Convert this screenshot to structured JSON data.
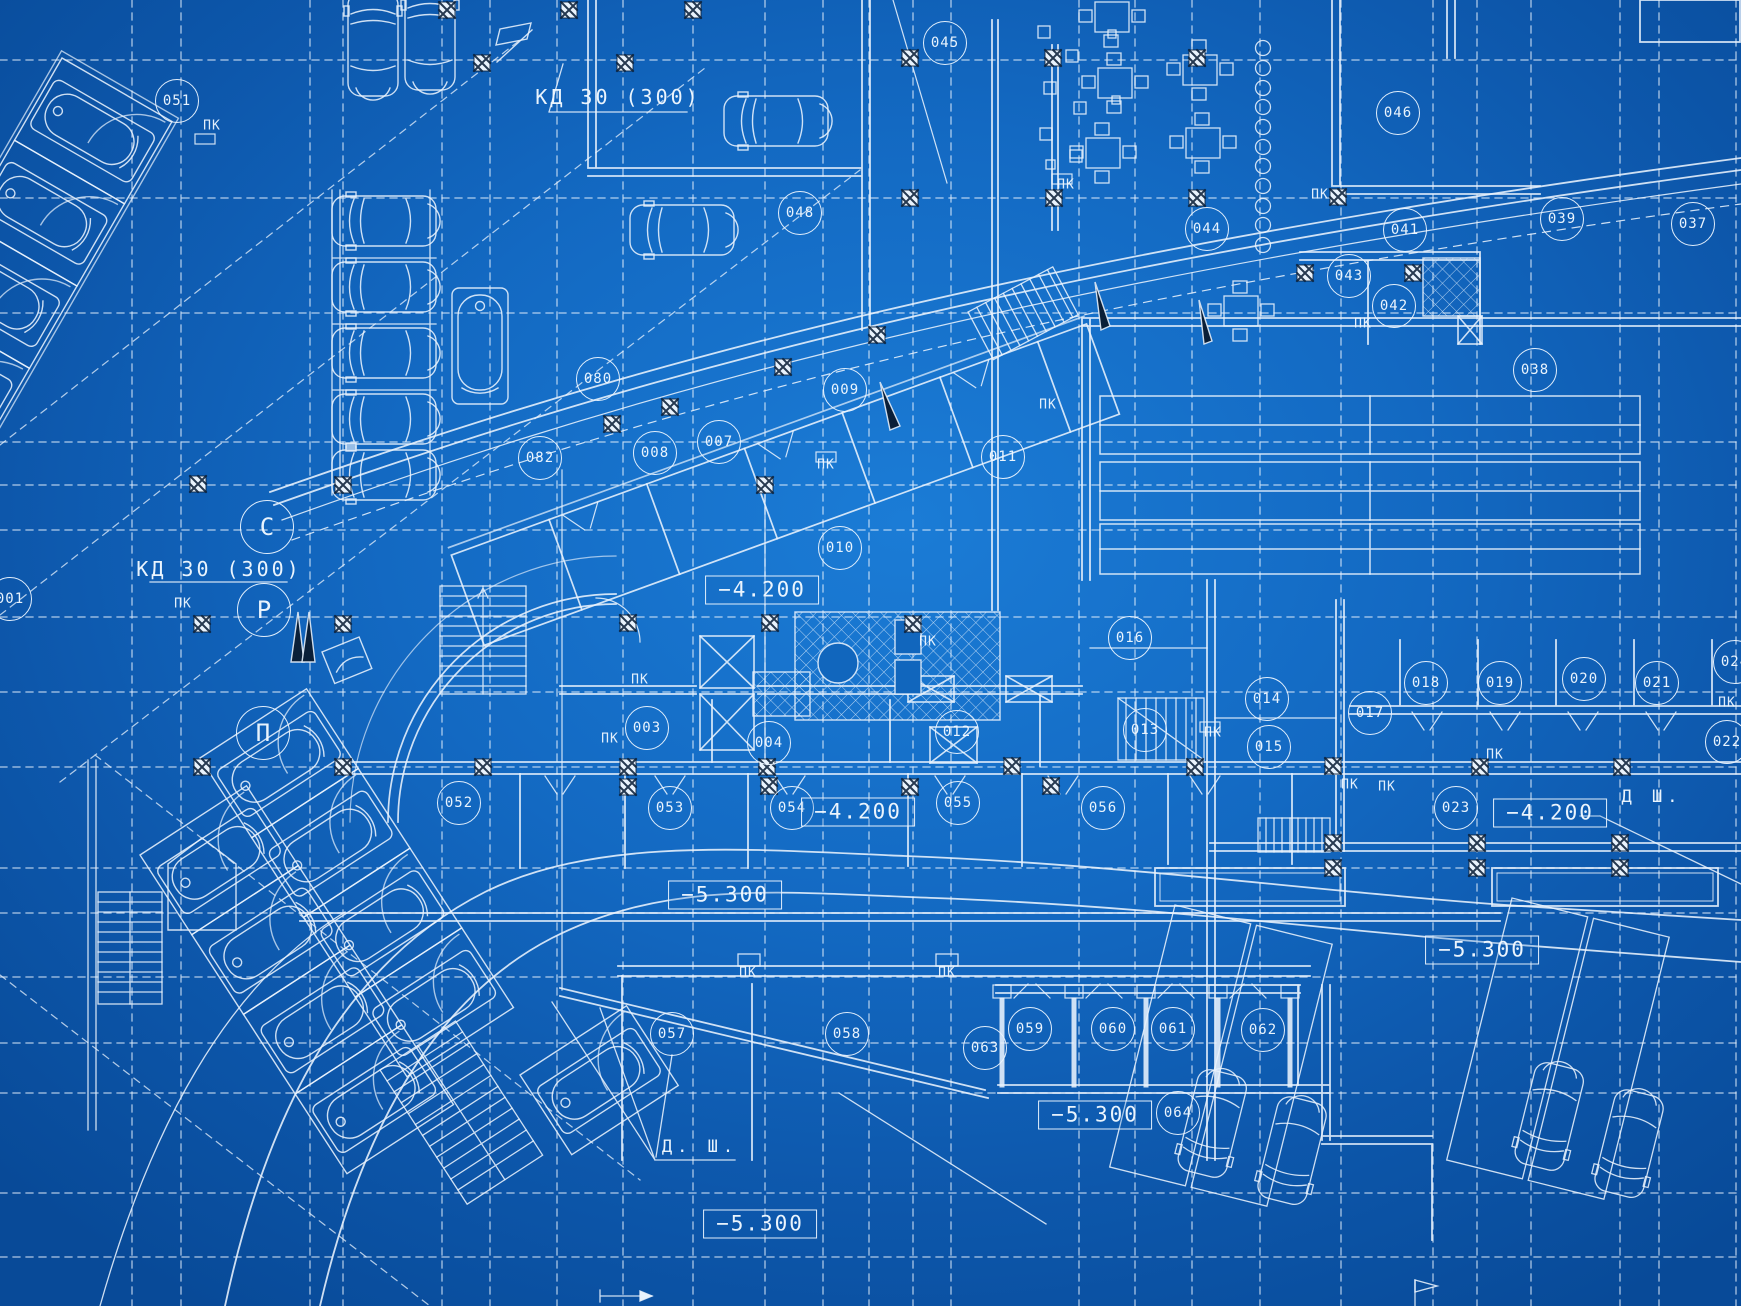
{
  "palette": {
    "background_center": "#1b7cd6",
    "background_edge": "#084a98",
    "line_color": "#e9f3fd",
    "dark_detail": "#0a1f38"
  },
  "callouts": {
    "duct_labels": [
      {
        "text": "КД 30 (300)",
        "x": 618,
        "y": 97
      },
      {
        "text": "КД 30 (300)",
        "x": 219,
        "y": 569
      }
    ],
    "axis_bubbles": [
      {
        "label": "С",
        "x": 267,
        "y": 527
      },
      {
        "label": "Р",
        "x": 264,
        "y": 610
      },
      {
        "label": "П",
        "x": 263,
        "y": 733
      }
    ],
    "room_bubbles": [
      {
        "label": "051",
        "x": 177,
        "y": 101
      },
      {
        "label": "045",
        "x": 945,
        "y": 43
      },
      {
        "label": "046",
        "x": 1398,
        "y": 113
      },
      {
        "label": "048",
        "x": 800,
        "y": 213
      },
      {
        "label": "044",
        "x": 1207,
        "y": 229
      },
      {
        "label": "041",
        "x": 1405,
        "y": 230
      },
      {
        "label": "039",
        "x": 1562,
        "y": 219
      },
      {
        "label": "037",
        "x": 1693,
        "y": 224
      },
      {
        "label": "043",
        "x": 1349,
        "y": 276
      },
      {
        "label": "042",
        "x": 1394,
        "y": 306
      },
      {
        "label": "038",
        "x": 1535,
        "y": 370
      },
      {
        "label": "080",
        "x": 598,
        "y": 379
      },
      {
        "label": "009",
        "x": 845,
        "y": 390
      },
      {
        "label": "007",
        "x": 719,
        "y": 442
      },
      {
        "label": "008",
        "x": 655,
        "y": 453
      },
      {
        "label": "082",
        "x": 540,
        "y": 458
      },
      {
        "label": "011",
        "x": 1003,
        "y": 457
      },
      {
        "label": "010",
        "x": 840,
        "y": 548
      },
      {
        "label": "001",
        "x": 10,
        "y": 599
      },
      {
        "label": "016",
        "x": 1130,
        "y": 638
      },
      {
        "label": "014",
        "x": 1267,
        "y": 699
      },
      {
        "label": "015",
        "x": 1269,
        "y": 747
      },
      {
        "label": "012",
        "x": 957,
        "y": 732
      },
      {
        "label": "013",
        "x": 1145,
        "y": 730
      },
      {
        "label": "017",
        "x": 1370,
        "y": 713
      },
      {
        "label": "018",
        "x": 1426,
        "y": 683
      },
      {
        "label": "019",
        "x": 1500,
        "y": 683
      },
      {
        "label": "020",
        "x": 1584,
        "y": 679
      },
      {
        "label": "021",
        "x": 1657,
        "y": 683
      },
      {
        "label": "024",
        "x": 1735,
        "y": 662
      },
      {
        "label": "022",
        "x": 1727,
        "y": 742
      },
      {
        "label": "023",
        "x": 1456,
        "y": 808
      },
      {
        "label": "003",
        "x": 647,
        "y": 728
      },
      {
        "label": "004",
        "x": 769,
        "y": 743
      },
      {
        "label": "052",
        "x": 459,
        "y": 803
      },
      {
        "label": "053",
        "x": 670,
        "y": 808
      },
      {
        "label": "054",
        "x": 792,
        "y": 808
      },
      {
        "label": "055",
        "x": 958,
        "y": 803
      },
      {
        "label": "056",
        "x": 1103,
        "y": 808
      },
      {
        "label": "057",
        "x": 672,
        "y": 1034
      },
      {
        "label": "058",
        "x": 847,
        "y": 1034
      },
      {
        "label": "063",
        "x": 985,
        "y": 1048
      },
      {
        "label": "059",
        "x": 1030,
        "y": 1029
      },
      {
        "label": "060",
        "x": 1113,
        "y": 1029
      },
      {
        "label": "061",
        "x": 1173,
        "y": 1029
      },
      {
        "label": "062",
        "x": 1263,
        "y": 1030
      },
      {
        "label": "064",
        "x": 1178,
        "y": 1113
      }
    ],
    "level_marks": [
      {
        "value": "−4.200",
        "x": 762,
        "y": 590
      },
      {
        "value": "−4.200",
        "x": 858,
        "y": 812
      },
      {
        "value": "−4.200",
        "x": 1550,
        "y": 813
      },
      {
        "value": "−5.300",
        "x": 725,
        "y": 895
      },
      {
        "value": "−5.300",
        "x": 1482,
        "y": 950
      },
      {
        "value": "−5.300",
        "x": 1095,
        "y": 1115
      },
      {
        "value": "−5.300",
        "x": 760,
        "y": 1224
      }
    ],
    "pk_marks": [
      {
        "text": "ПК",
        "x": 212,
        "y": 126
      },
      {
        "text": "ПК",
        "x": 1066,
        "y": 185
      },
      {
        "text": "ПК",
        "x": 1320,
        "y": 195
      },
      {
        "text": "ПК",
        "x": 1363,
        "y": 324
      },
      {
        "text": "ПК",
        "x": 826,
        "y": 465
      },
      {
        "text": "ПК",
        "x": 1048,
        "y": 405
      },
      {
        "text": "ПК",
        "x": 183,
        "y": 604
      },
      {
        "text": "ПК",
        "x": 928,
        "y": 642
      },
      {
        "text": "ПК",
        "x": 640,
        "y": 680
      },
      {
        "text": "ПК",
        "x": 610,
        "y": 739
      },
      {
        "text": "ПК",
        "x": 1213,
        "y": 733
      },
      {
        "text": "ПК",
        "x": 1350,
        "y": 785
      },
      {
        "text": "ПК",
        "x": 1387,
        "y": 787
      },
      {
        "text": "ПК",
        "x": 1495,
        "y": 755
      },
      {
        "text": "ПК",
        "x": 1727,
        "y": 703
      },
      {
        "text": "ПК",
        "x": 748,
        "y": 973
      },
      {
        "text": "ПК",
        "x": 947,
        "y": 973
      }
    ],
    "shaft_labels": [
      {
        "text": "Д. Ш.",
        "x": 700,
        "y": 1147
      },
      {
        "text": "Д Ш.",
        "x": 1652,
        "y": 797
      }
    ]
  }
}
